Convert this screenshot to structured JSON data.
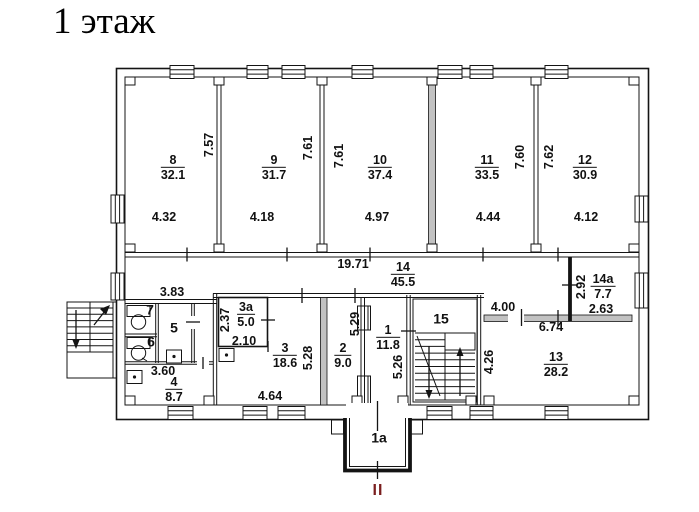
{
  "title": "1 этаж",
  "colors": {
    "ink": "#111111",
    "entrance_mark": "#7a1e1e",
    "paper": "#ffffff"
  },
  "upper_rooms": {
    "r8": {
      "num": "8",
      "area": "32.1",
      "depth": "7.57",
      "width": "4.32"
    },
    "r9": {
      "num": "9",
      "area": "31.7",
      "depth": "7.61",
      "width": "4.18"
    },
    "r10": {
      "num": "10",
      "area": "37.4",
      "depth": "7.61",
      "width": "4.97"
    },
    "r11": {
      "num": "11",
      "area": "33.5",
      "depth": "7.60",
      "width": "4.44"
    },
    "r12": {
      "num": "12",
      "area": "30.9",
      "depth": "7.62",
      "width": "4.12"
    }
  },
  "corridor": {
    "num": "14",
    "area": "45.5",
    "length": "19.71"
  },
  "lower": {
    "block_width": "3.83",
    "r7": {
      "num": "7"
    },
    "r5": {
      "num": "5"
    },
    "r6": {
      "num": "6"
    },
    "r4": {
      "num": "4",
      "area": "8.7",
      "width": "3.60"
    },
    "r3a": {
      "num": "3а",
      "area": "5.0",
      "depth": "2.37",
      "width": "2.10"
    },
    "r3": {
      "num": "3",
      "area": "18.6",
      "depth": "5.28",
      "width": "4.64"
    },
    "r2": {
      "num": "2",
      "area": "9.0",
      "depth": "5.29"
    },
    "r1": {
      "num": "1",
      "area": "11.8",
      "depth": "5.26"
    },
    "r15": {
      "num": "15"
    },
    "r13": {
      "num": "13",
      "area": "28.2",
      "depth": "4.26",
      "width": "6.74",
      "offset": "4.00"
    },
    "r14a": {
      "num": "14а",
      "area": "7.7",
      "depth": "2.92",
      "width": "2.63"
    }
  },
  "entrance": {
    "vestibule": "1а",
    "mark": "II"
  }
}
